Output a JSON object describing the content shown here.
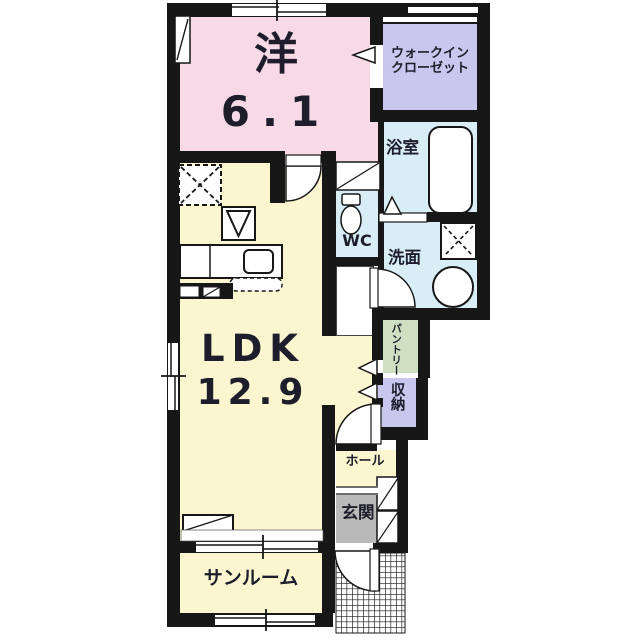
{
  "plan_title": "1LDK apartment floor plan",
  "colors": {
    "wall": "#171717",
    "room_pink": "#f8d9e6",
    "room_lavender": "#c8c8ee",
    "room_blue": "#d8edf5",
    "room_yellow": "#fbf6cf",
    "room_green": "#cfe0c2",
    "room_gray": "#b9b9b9",
    "nook_white": "#ffffff"
  },
  "rooms": {
    "western": {
      "label": "洋",
      "size": "6.1"
    },
    "walkin_closet": {
      "line1": "ウォークイン",
      "line2": "クローゼット"
    },
    "bathroom": {
      "label": "浴室"
    },
    "wc": {
      "label": "WC"
    },
    "washroom": {
      "label": "洗面"
    },
    "pantry": {
      "label": "パントリー"
    },
    "storage": {
      "label": "収納"
    },
    "ldk": {
      "label": "LDK",
      "size": "12.9"
    },
    "hall": {
      "label": "ホール"
    },
    "entrance": {
      "label": "玄関"
    },
    "sunroom": {
      "label": "サンルーム"
    }
  }
}
